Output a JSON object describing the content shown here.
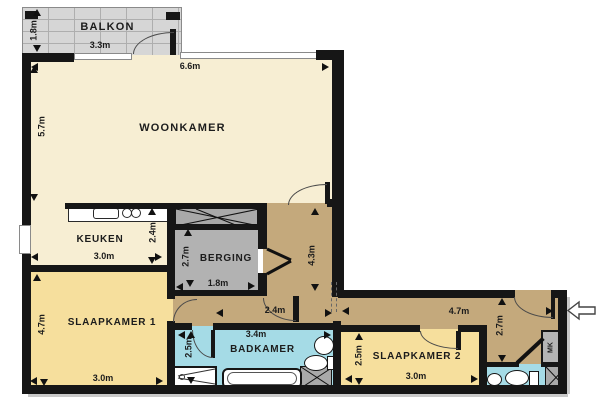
{
  "plan_title": "apartment floor plan",
  "colors": {
    "living_floor": "#f7eed3",
    "bedroom_floor": "#f6df9d",
    "hall_floor": "#c4a97c",
    "bathroom_floor": "#a5dbe6",
    "storage_floor": "#b2b2b2",
    "balcony_floor": "#d6d6d6",
    "wall": "#161616"
  },
  "rooms": {
    "balkon": {
      "name": "BALKON",
      "width": "3.3m",
      "depth": "1.8m"
    },
    "woonkamer": {
      "name": "WOONKAMER",
      "width": "6.6m",
      "depth": "5.7m"
    },
    "keuken": {
      "name": "KEUKEN",
      "width": "3.0m",
      "depth": "2.4m"
    },
    "berging": {
      "name": "BERGING",
      "width": "1.8m",
      "depth": "2.7m"
    },
    "slaapkamer1": {
      "name": "SLAAPKAMER 1",
      "width": "3.0m",
      "depth": "4.7m"
    },
    "badkamer": {
      "name": "BADKAMER",
      "width": "3.4m",
      "depth": "2.5m"
    },
    "slaapkamer2": {
      "name": "SLAAPKAMER 2",
      "width": "3.0m",
      "depth": "2.5m"
    },
    "meterkast": {
      "name": "MK"
    }
  },
  "hall": {
    "corridor_depth": "4.3m",
    "inner_width": "2.4m",
    "entry_width": "4.7m",
    "entry_depth": "2.7m"
  }
}
